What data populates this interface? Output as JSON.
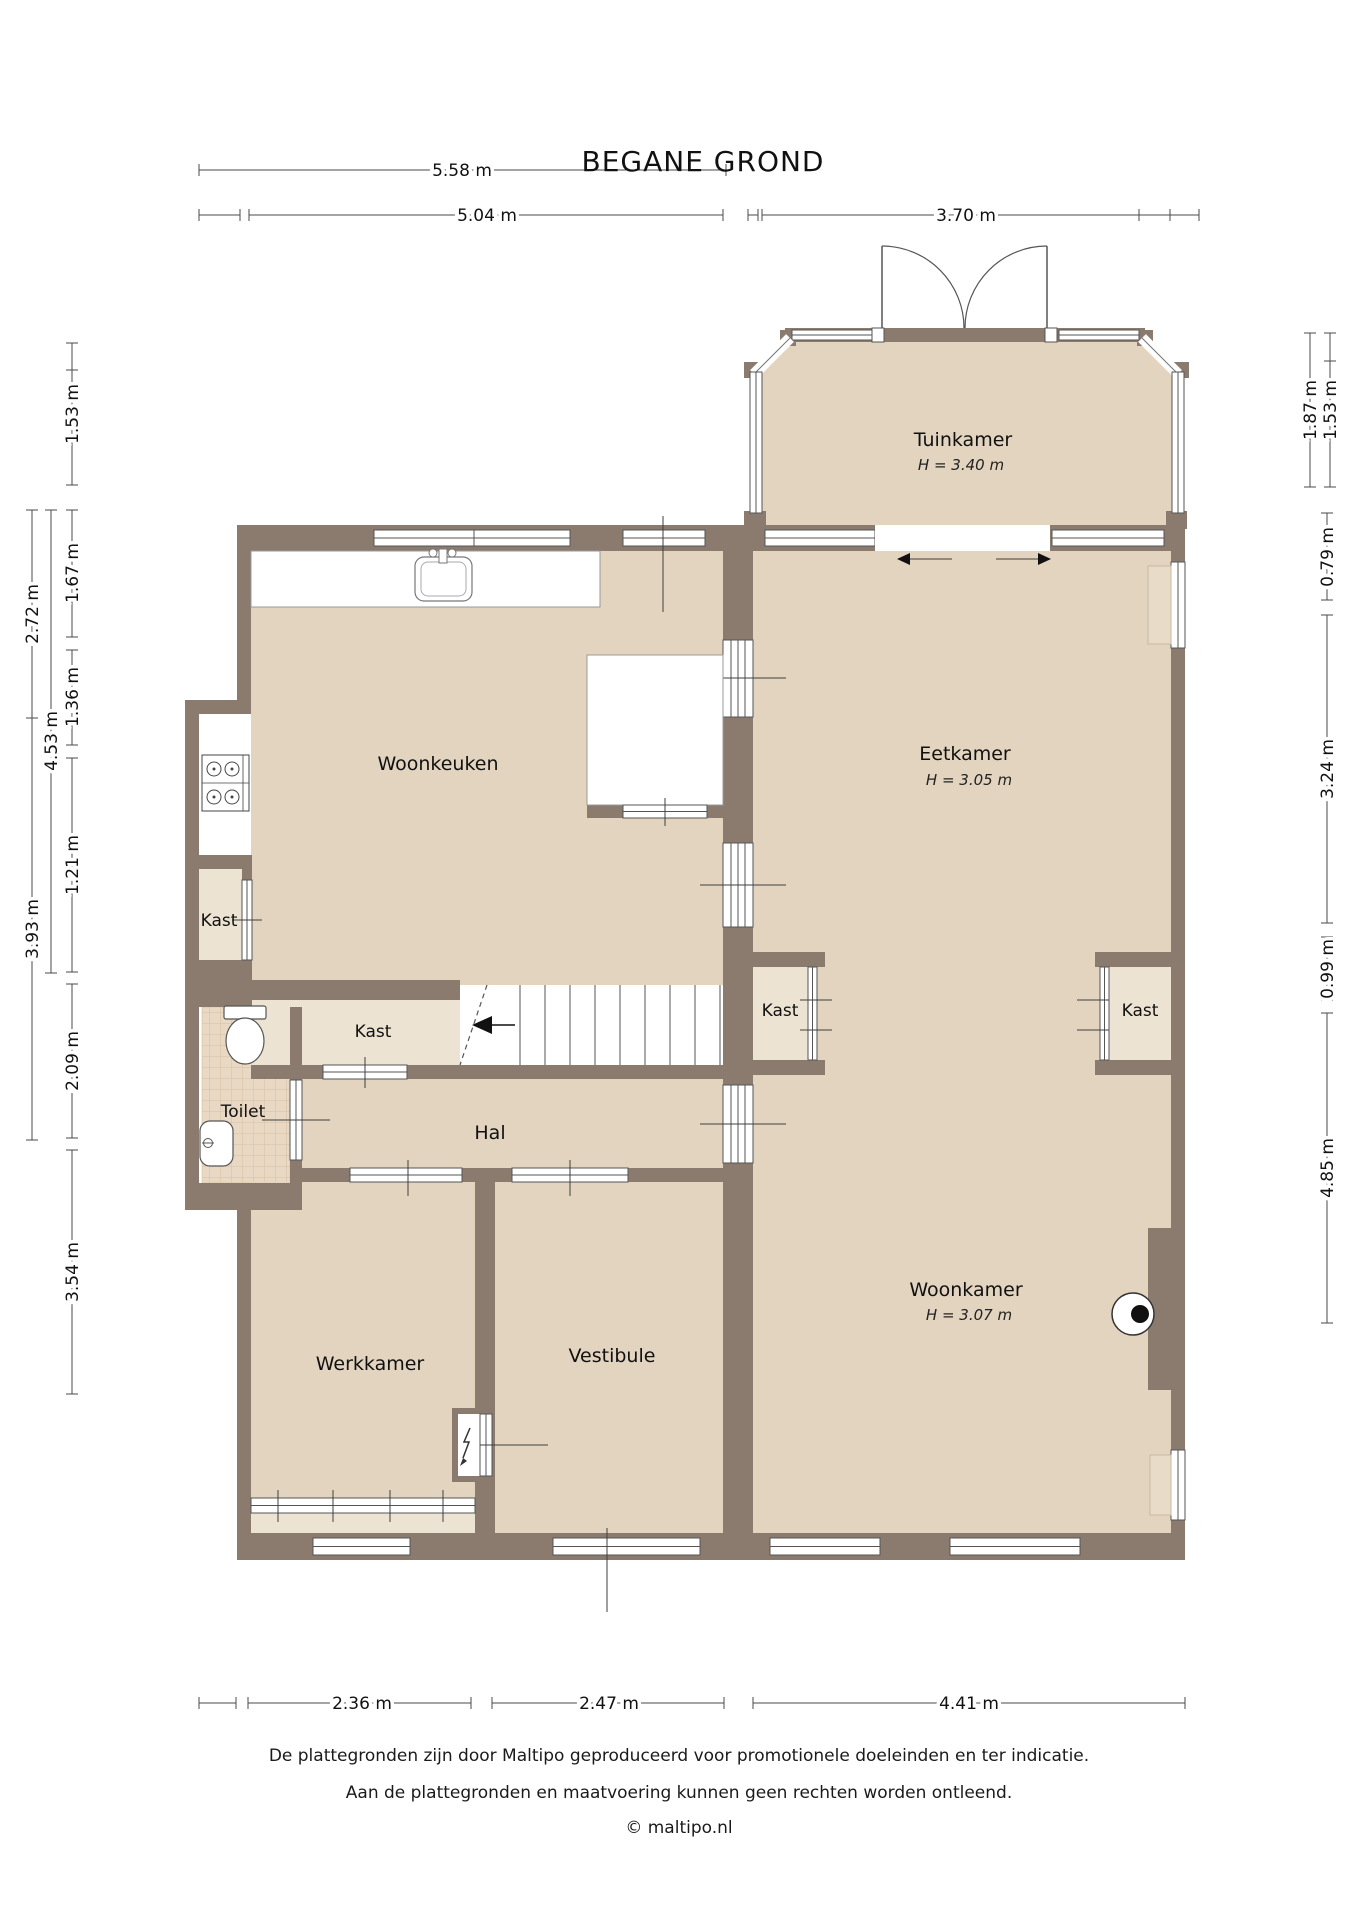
{
  "title": "BEGANE GROND",
  "rooms": {
    "tuinkamer": {
      "name": "Tuinkamer",
      "height": "H = 3.40 m"
    },
    "woonkeuken": {
      "name": "Woonkeuken"
    },
    "eetkamer": {
      "name": "Eetkamer",
      "height": "H = 3.05 m"
    },
    "woonkamer": {
      "name": "Woonkamer",
      "height": "H = 3.07 m"
    },
    "kast": {
      "name": "Kast"
    },
    "toilet": {
      "name": "Toilet"
    },
    "hal": {
      "name": "Hal"
    },
    "werkkamer": {
      "name": "Werkkamer"
    },
    "vestibule": {
      "name": "Vestibule"
    }
  },
  "dims": {
    "top": [
      "5.58 m",
      "5.04 m",
      "3.70 m"
    ],
    "left": [
      "1.53 m",
      "1.67 m",
      "1.36 m",
      "1.21 m",
      "2.09 m",
      "3.54 m",
      "4.53 m",
      "2.72 m",
      "3.93 m"
    ],
    "right": [
      "1.87 m",
      "1.53 m",
      "0.79 m",
      "3.24 m",
      "0.99 m",
      "4.85 m"
    ],
    "bottom": [
      "2.36 m",
      "2.47 m",
      "4.41 m"
    ]
  },
  "footer": {
    "line1": "De plattegronden zijn door Maltipo geproduceerd voor promotionele doeleinden en ter indicatie.",
    "line2": "Aan de plattegronden en maatvoering kunnen geen rechten worden ontleend.",
    "line3": "© maltipo.nl"
  },
  "colors": {
    "wall": "#8a7b6e",
    "floor": "#e2d4bf",
    "floor_light": "#ece3d3",
    "tile": "#e9d8c3"
  },
  "fixtures": {
    "kitchen_sink": "sink-icon",
    "stove": "stove-icon",
    "toilet_bowl": "toilet-icon",
    "hand_basin": "basin-icon",
    "wood_stove": "wood-stove-icon",
    "meter_cupboard": "lightning-icon",
    "stairs": "stairs-up-icon",
    "garden_doors": "double-door-icon"
  }
}
